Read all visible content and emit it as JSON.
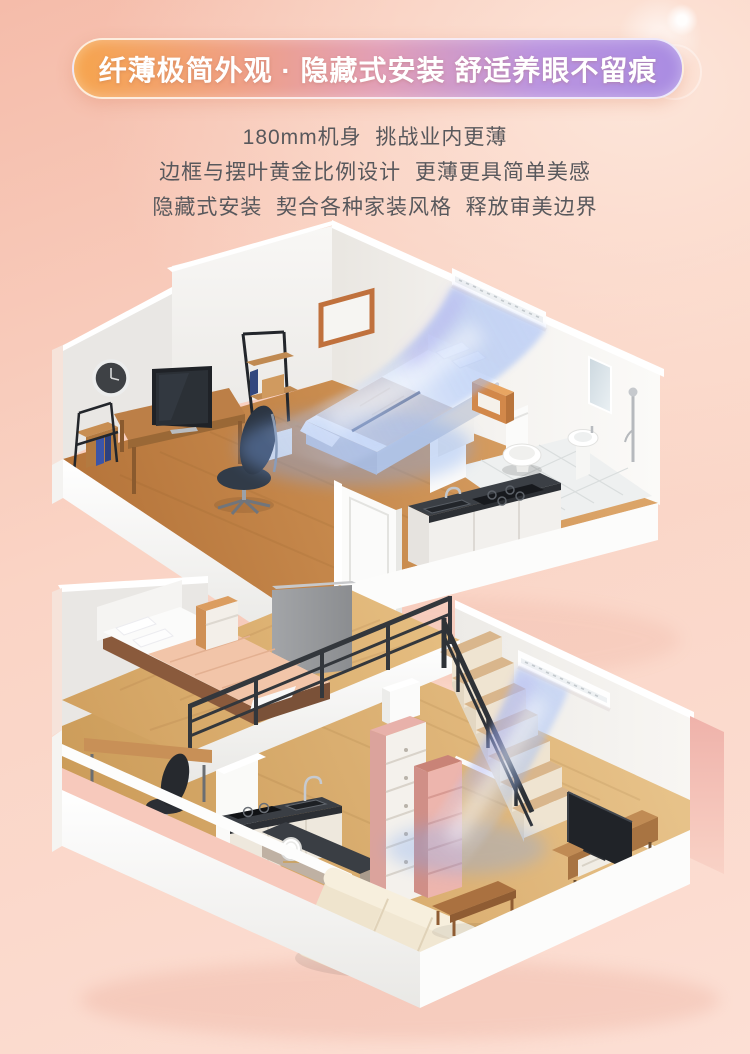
{
  "banner": {
    "title": "纤薄极简外观 · 隐藏式安装 舒适养眼不留痕"
  },
  "description": {
    "lines": [
      "180mm机身  挑战业内更薄",
      "边框与摆叶黄金比例设计  更薄更具简单美感",
      "隐藏式安装  契合各种家装风格  释放审美边界"
    ]
  },
  "theme": {
    "bg-top": "#f5bcaa",
    "bg-mid": "#fad4c5",
    "bg-bottom": "#fcdfd4",
    "bg-light": "#fde6da",
    "banner-from": "#f6a44c",
    "banner-to": "#a98ce2",
    "banner-text": "#ffffff",
    "desc-text": "#58585c",
    "airflow-blue": "#8fb4f4",
    "wood-floor": "#c07c41",
    "wood-light": "#dcb173",
    "wall-white": "#f6f5f3",
    "wall-gray": "#e9e7e4",
    "accent-dark": "#33373c"
  },
  "scene": {
    "objects": [
      "wall-clock",
      "ladder-shelf",
      "desk",
      "television",
      "office-chair",
      "picture-frame",
      "double-bed",
      "nightstand",
      "hidden-ac-unit",
      "cool-airflow",
      "toilet",
      "pedestal-sink",
      "mirror",
      "shower",
      "kitchen-counter",
      "open-door",
      "loft-bed",
      "loft-railing",
      "staircase",
      "stair-railing",
      "drawer-chest",
      "mini-fridge",
      "kitchen-island",
      "plate",
      "tv-console",
      "sofa",
      "coffee-table"
    ]
  }
}
